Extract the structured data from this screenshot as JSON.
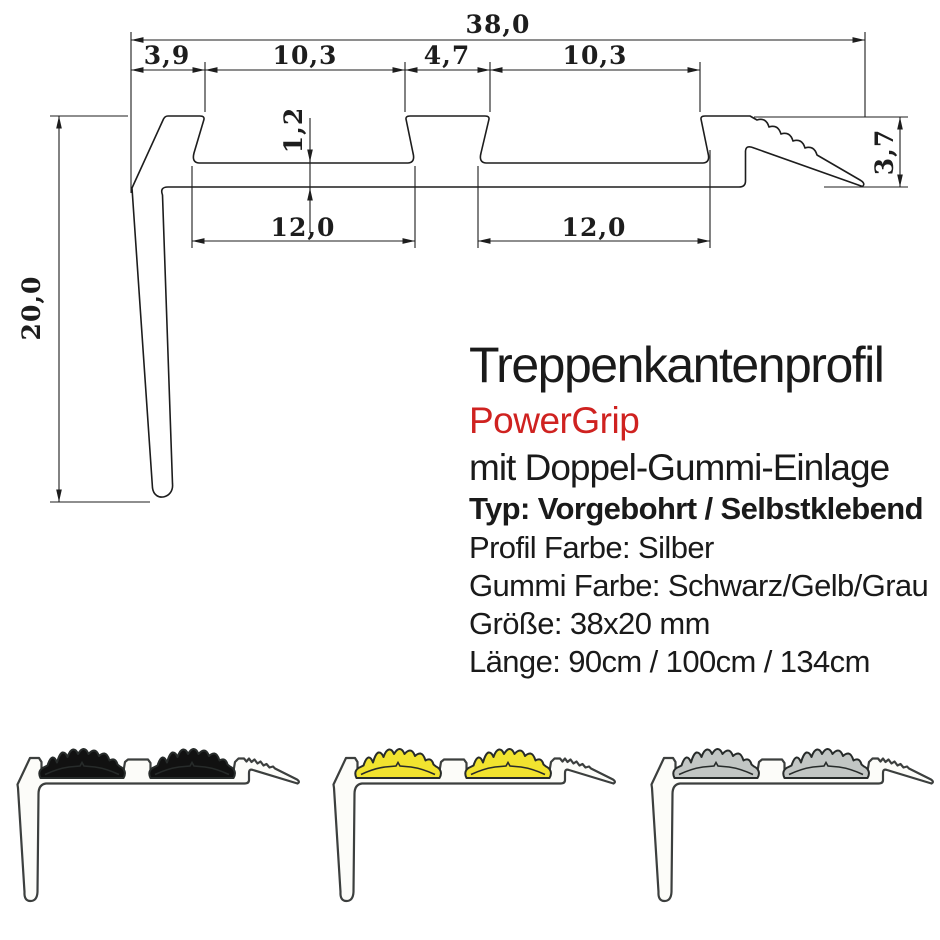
{
  "drawing": {
    "line_color": "#1d1d1d",
    "dimensions": {
      "total_width": "38,0",
      "left_offset": "3,9",
      "insert_top_1": "10,3",
      "center_web": "4,7",
      "insert_top_2": "10,3",
      "base_thickness": "1,2",
      "insert_base_1": "12,0",
      "insert_base_2": "12,0",
      "profile_height": "20,0",
      "nose_height": "3,7"
    }
  },
  "info": {
    "title": "Treppenkantenprofil",
    "brand": "PowerGrip",
    "brand_color": "#cf2220",
    "subtitle": "mit Doppel-Gummi-Einlage",
    "type_line": "Typ: Vorgebohrt / Selbstklebend",
    "profile_color_line": "Profil Farbe: Silber",
    "rubber_color_line": "Gummi Farbe: Schwarz/Gelb/Grau",
    "size_line": "Größe: 38x20 mm",
    "length_line": "Länge: 90cm / 100cm / 134cm"
  },
  "photo": {
    "aluminum_fill": "#fcfcf9",
    "outline_color": "#3c3f3e",
    "rubber_outline": "#272b2a"
  },
  "variants": [
    {
      "name": "schwarz",
      "rubber_color": "#111111"
    },
    {
      "name": "gelb",
      "rubber_color": "#f1e32f"
    },
    {
      "name": "grau",
      "rubber_color": "#c2c6c4"
    }
  ]
}
